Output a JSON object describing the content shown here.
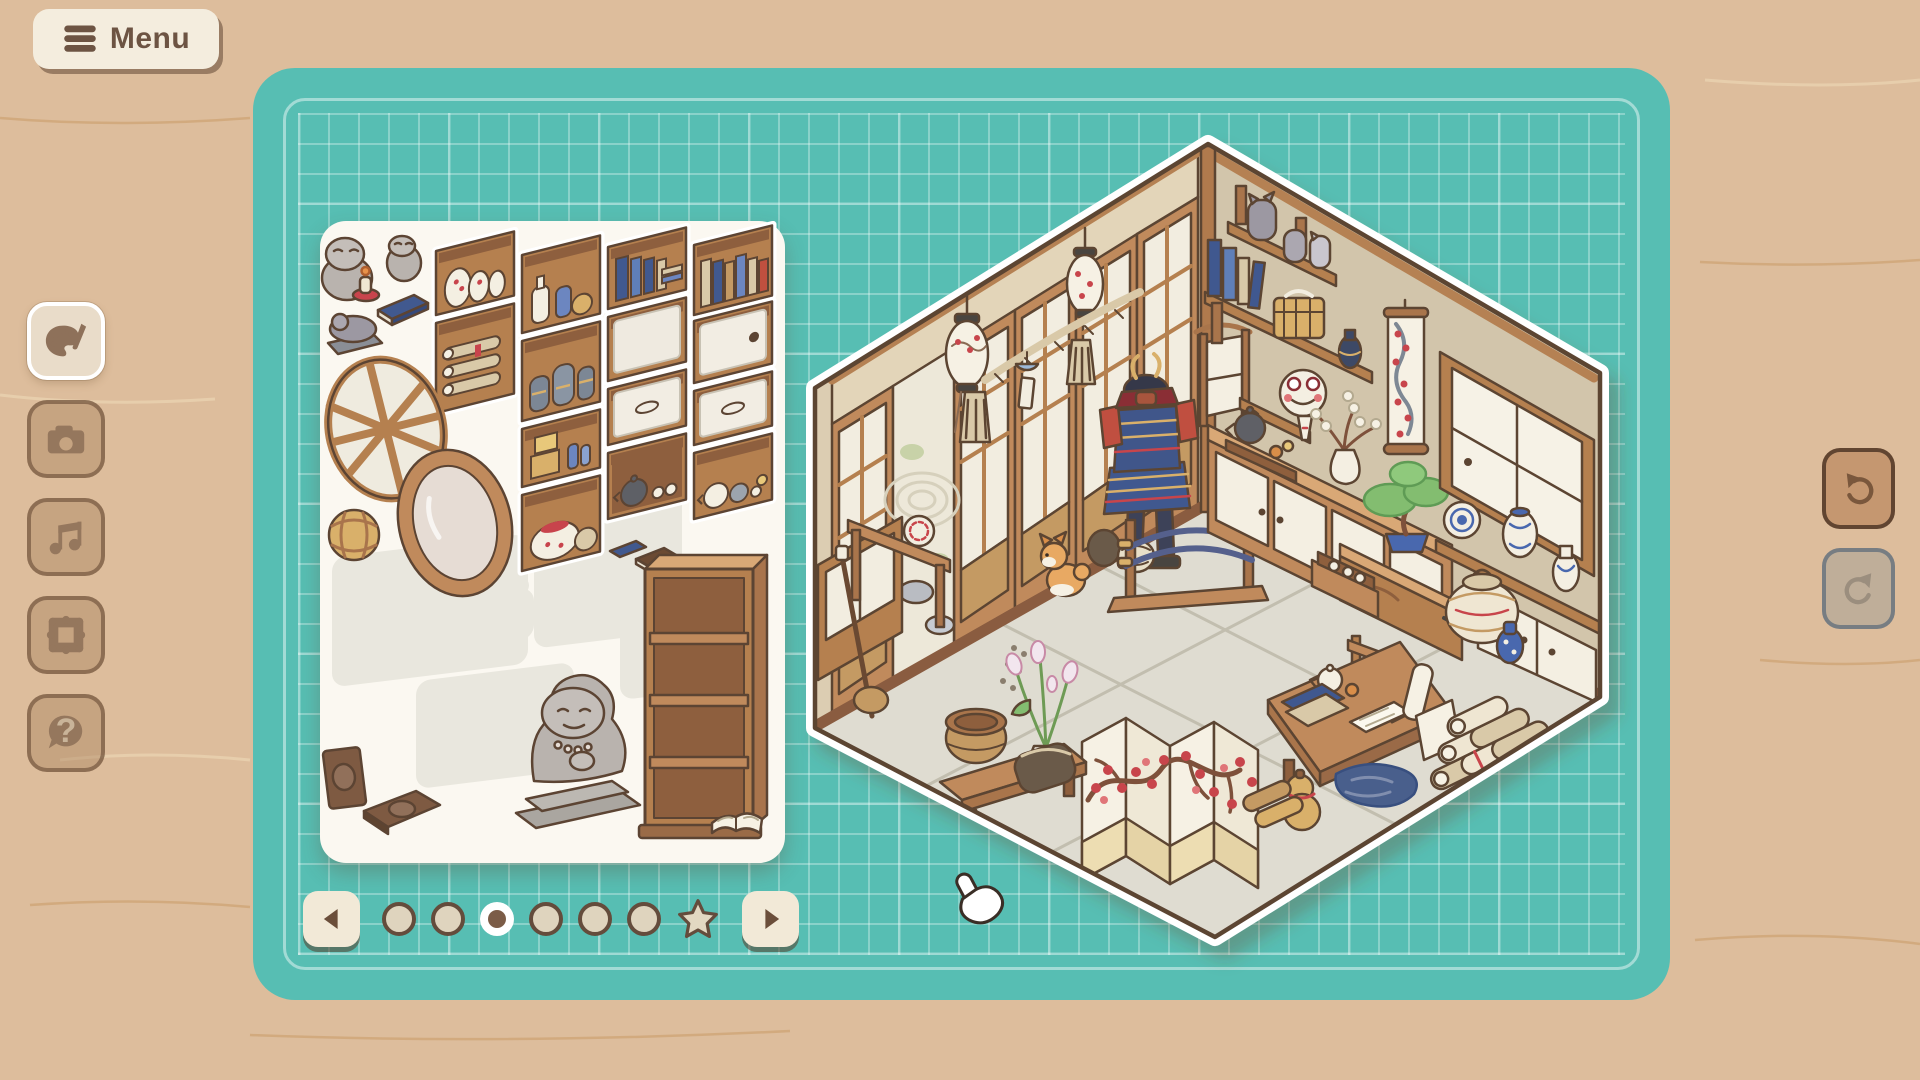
{
  "menu": {
    "label": "Menu"
  },
  "sidebar": {
    "items": [
      {
        "id": "decorate",
        "icon": "palette-brush",
        "active": true,
        "enabled": true
      },
      {
        "id": "photo",
        "icon": "camera",
        "active": false,
        "enabled": true
      },
      {
        "id": "music",
        "icon": "music-note",
        "active": false,
        "enabled": true
      },
      {
        "id": "frame",
        "icon": "picture-frame",
        "active": false,
        "enabled": true
      },
      {
        "id": "help",
        "icon": "question-bubble",
        "active": false,
        "enabled": true,
        "glyph": "?"
      }
    ]
  },
  "history": {
    "undo": {
      "icon": "undo-arrow",
      "enabled": true
    },
    "redo": {
      "icon": "redo-arrow",
      "enabled": false
    }
  },
  "pager": {
    "active_index": 2,
    "pages": [
      {
        "type": "dot"
      },
      {
        "type": "dot"
      },
      {
        "type": "dot"
      },
      {
        "type": "dot"
      },
      {
        "type": "dot"
      },
      {
        "type": "dot"
      },
      {
        "type": "star"
      }
    ]
  },
  "tray": {
    "shelf_tiles": [
      {
        "id": "plum-vase-shelf",
        "type": "vases",
        "x": 116,
        "y": 30,
        "w": 78,
        "h": 64
      },
      {
        "id": "scroll-shelf",
        "type": "scrolls",
        "x": 116,
        "y": 102,
        "w": 78,
        "h": 90
      },
      {
        "id": "sake-bottle-shelf",
        "type": "sake",
        "x": 202,
        "y": 34,
        "w": 78,
        "h": 78
      },
      {
        "id": "stone-jar-shelf",
        "type": "jars",
        "x": 202,
        "y": 120,
        "w": 78,
        "h": 80
      },
      {
        "id": "tea-box-shelf",
        "type": "boxes",
        "x": 202,
        "y": 208,
        "w": 78,
        "h": 58
      },
      {
        "id": "hot-pot-shelf",
        "type": "pot",
        "x": 202,
        "y": 274,
        "w": 78,
        "h": 76
      },
      {
        "id": "blue-book-shelf",
        "type": "books-blue",
        "x": 288,
        "y": 26,
        "w": 78,
        "h": 62
      },
      {
        "id": "plain-panel",
        "type": "panel",
        "x": 288,
        "y": 96,
        "w": 78,
        "h": 64
      },
      {
        "id": "drawer-front",
        "type": "drawer",
        "x": 288,
        "y": 168,
        "w": 78,
        "h": 56
      },
      {
        "id": "teapot-shelf",
        "type": "teapots",
        "x": 288,
        "y": 232,
        "w": 78,
        "h": 66
      },
      {
        "id": "book-row-shelf",
        "type": "books-tan",
        "x": 374,
        "y": 24,
        "w": 78,
        "h": 70
      },
      {
        "id": "door-panel-knob",
        "type": "panel-knob",
        "x": 374,
        "y": 100,
        "w": 78,
        "h": 62
      },
      {
        "id": "drawer-front-wide",
        "type": "drawer",
        "x": 374,
        "y": 170,
        "w": 78,
        "h": 54
      },
      {
        "id": "tea-set-shelf",
        "type": "teaset",
        "x": 374,
        "y": 232,
        "w": 78,
        "h": 66
      }
    ],
    "empty_slots": [
      {
        "x": 12,
        "y": 338,
        "w": 196,
        "h": 130,
        "shape": "rect"
      },
      {
        "x": 214,
        "y": 306,
        "w": 148,
        "h": 148,
        "shape": "rect"
      },
      {
        "x": 96,
        "y": 472,
        "w": 158,
        "h": 108,
        "shape": "rect"
      },
      {
        "x": 300,
        "y": 424,
        "w": 116,
        "h": 92,
        "shape": "rect"
      },
      {
        "x": 150,
        "y": 392,
        "w": 64,
        "h": 52,
        "shape": "cat"
      },
      {
        "x": 240,
        "y": 252,
        "w": 44,
        "h": 40,
        "shape": "rect"
      }
    ],
    "loose_items": [
      "frog figurine with candle",
      "small frog figurine",
      "reclining frog statue",
      "blue book",
      "round lattice window",
      "oval mirror",
      "woven rattan ball",
      "frog monk statue",
      "tall wooden bookshelf",
      "brown album",
      "brown notebook",
      "open book",
      "small stacked books"
    ]
  },
  "room": {
    "style": "japanese-tatami-room",
    "items": [
      "paper lantern with plum pattern (left)",
      "paper lantern with plum pattern (upper)",
      "shimenawa rope with tassels",
      "wind chime with paper tag",
      "sliding shoji doors",
      "zen garden with raked sand and stones",
      "display plate",
      "wooden railing",
      "tansu cabinet",
      "shamisen",
      "samurai armor",
      "katana display stand",
      "shiba inu",
      "paw prints",
      "corner shoji lamp",
      "wall shelves with cat figurines",
      "blue books",
      "golden chest",
      "bud vase",
      "frog mask",
      "hanging plum-blossom scroll",
      "long cabinet with sliding doors",
      "teapot tray",
      "vase with blossom branches",
      "bonsai on tansu chest",
      "open drawer with teacups",
      "lattice window",
      "porcelain plate",
      "porcelain jar",
      "porcelain vase",
      "white closet panels",
      "woven storage jar",
      "blue bottle",
      "folding screen with plum blossoms",
      "lily vase",
      "wooden bench",
      "wooden bucket",
      "travel pouch",
      "writing desk",
      "white teapot",
      "tea cup",
      "book stack",
      "paper scroll",
      "book stand",
      "indigo cloth",
      "gourd",
      "pile of scrolls",
      "wood rolls"
    ]
  },
  "cursor": {
    "type": "white-glove-hand"
  },
  "colors": {
    "background": "#DDBD9C",
    "mat": "#57BEB3",
    "grid_line": "rgba(255,255,255,0.30)",
    "cream": "#F4EDDE",
    "text_brown": "#6D5443",
    "outline": "#5C4433",
    "wood": "#C08A5C",
    "wood_light": "#D9A876",
    "wood_dark": "#9A6B47",
    "paper": "#F3EEE1",
    "wall": "#D5C7AD",
    "floor": "#E1DED3",
    "red": "#C8444C",
    "navy": "#41598F",
    "gold": "#D9B06A",
    "green": "#83BD6F",
    "gray": "#9C98A2",
    "porcelain_blue": "#4A67AE"
  }
}
